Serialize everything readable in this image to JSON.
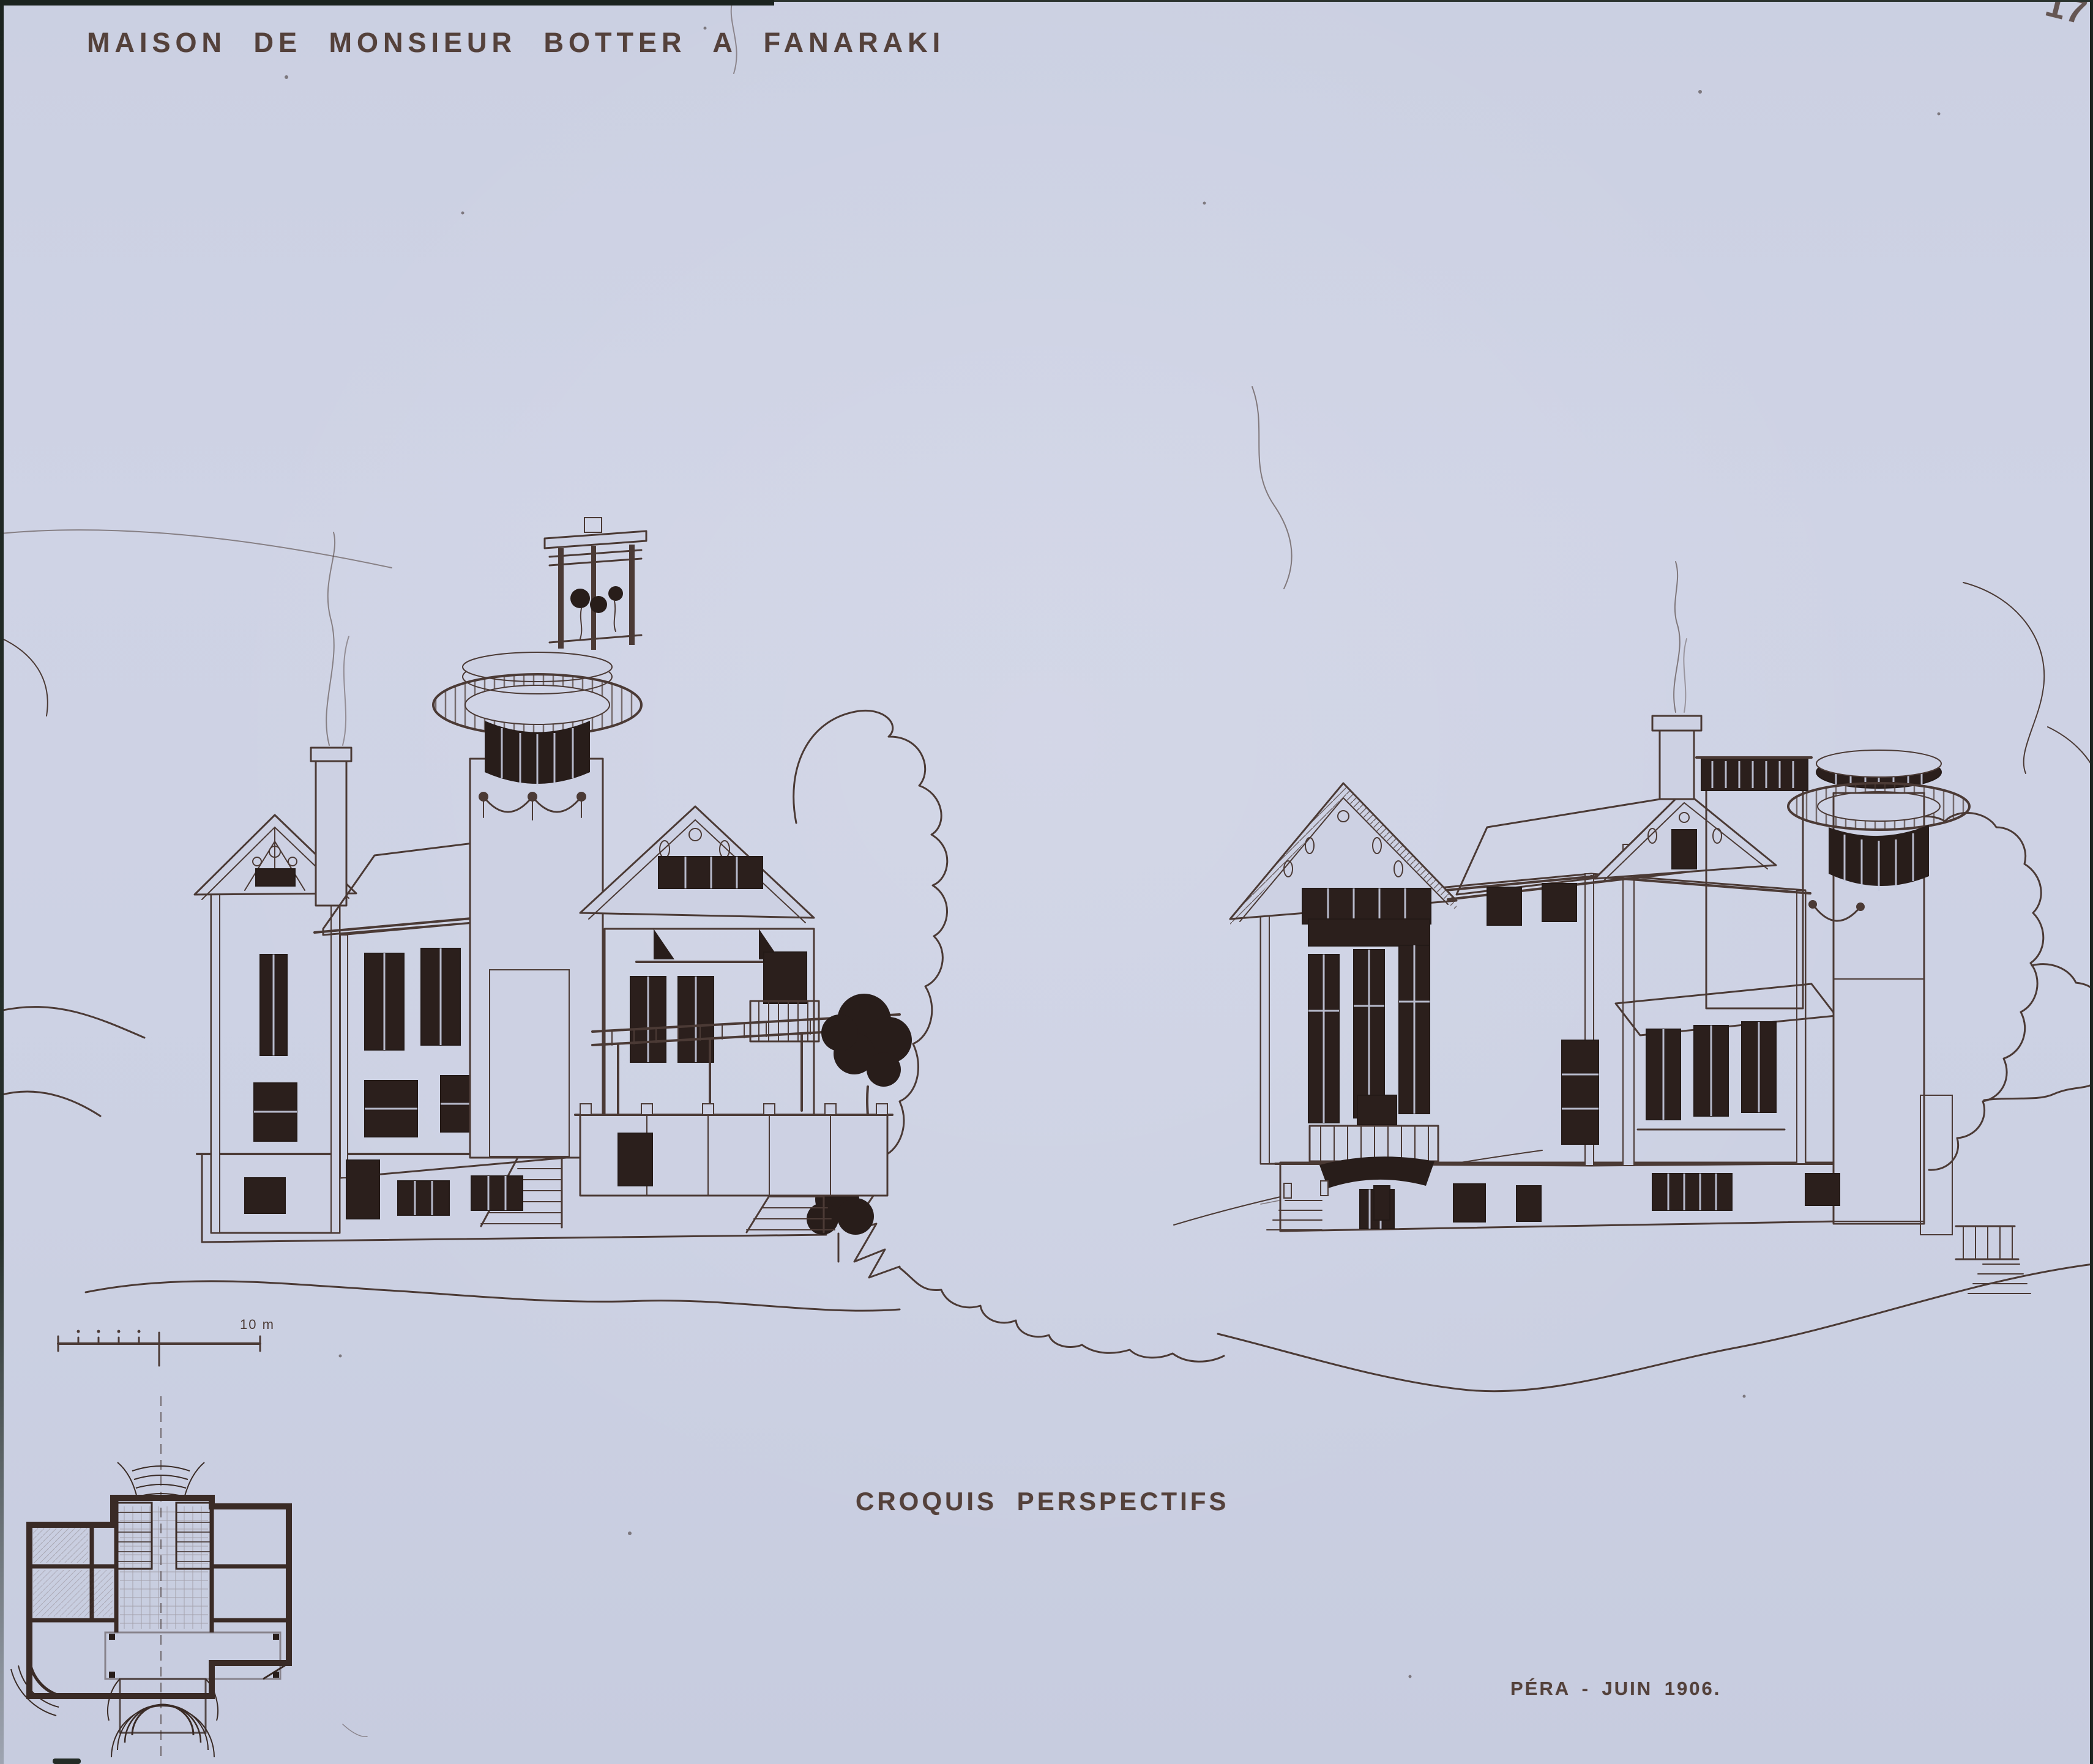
{
  "artwork": {
    "title": "MAISON DE MONSIEUR BOTTER A FANARAKI",
    "caption": "CROQUIS PERSPECTIFS",
    "signature": "PÉRA - JUIN 1906.",
    "corner_mark": "17",
    "scale_label": "10 m"
  },
  "colors": {
    "paper": "#cdd1e3",
    "ink": "#4b3a35",
    "window_ink": "#2b1f1c",
    "plan_ink": "#3a2b26",
    "slide_edge": "#1b231f"
  }
}
